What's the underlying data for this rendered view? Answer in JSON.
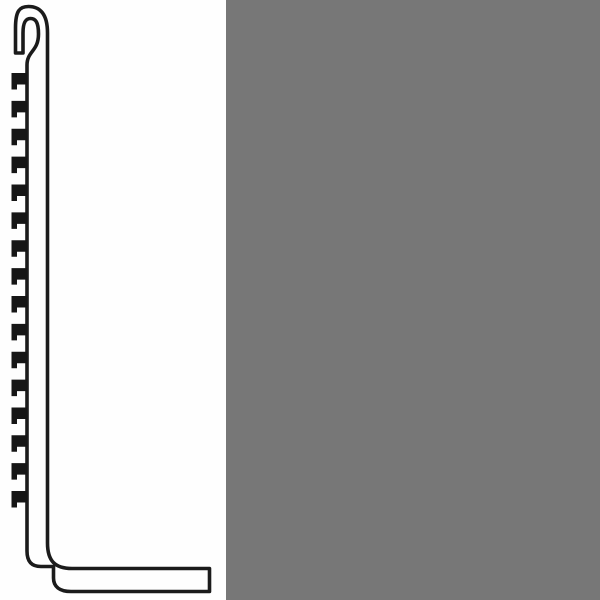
{
  "page": {
    "background_color": "#ffffff"
  },
  "panels": {
    "gray_panel": {
      "color": "#777777"
    }
  },
  "drawing": {
    "semantic": "skirting-profile-cross-section",
    "stroke_color": "#1b1b1b",
    "stroke_width": 3.6,
    "fill": "none",
    "outline_path": "M 15.5,53 L 15.5,28 C 15.5,11 19.5,6.5 28.5,6.5 C 40,6.5 47.5,14 47.5,33 L 47.5,543 C 47.5,561 55,568.5 72,568.5 L 209.5,568.5 L 209.5,591.5 L 71,591.5 C 59.5,591.5 53.5,586.5 53.5,578 L 53.5,566.5 L 41,566.5 C 31.5,566.5 27,561.5 27,551 L 27,65 C 27,51 38.5,51.5 38.5,34 C 38.5,22 35.5,18.5 30.5,18.5 C 25.5,18.5 23,22.5 23,33 L 23,53 Z",
    "teeth": {
      "count": 16,
      "first_y": 73,
      "spacing": 27.87,
      "inner_x": 27,
      "outer_x": 11.5,
      "tab_x": 17,
      "depth_main": 11.5,
      "depth_tab": 16.5,
      "color": "#161616"
    }
  }
}
